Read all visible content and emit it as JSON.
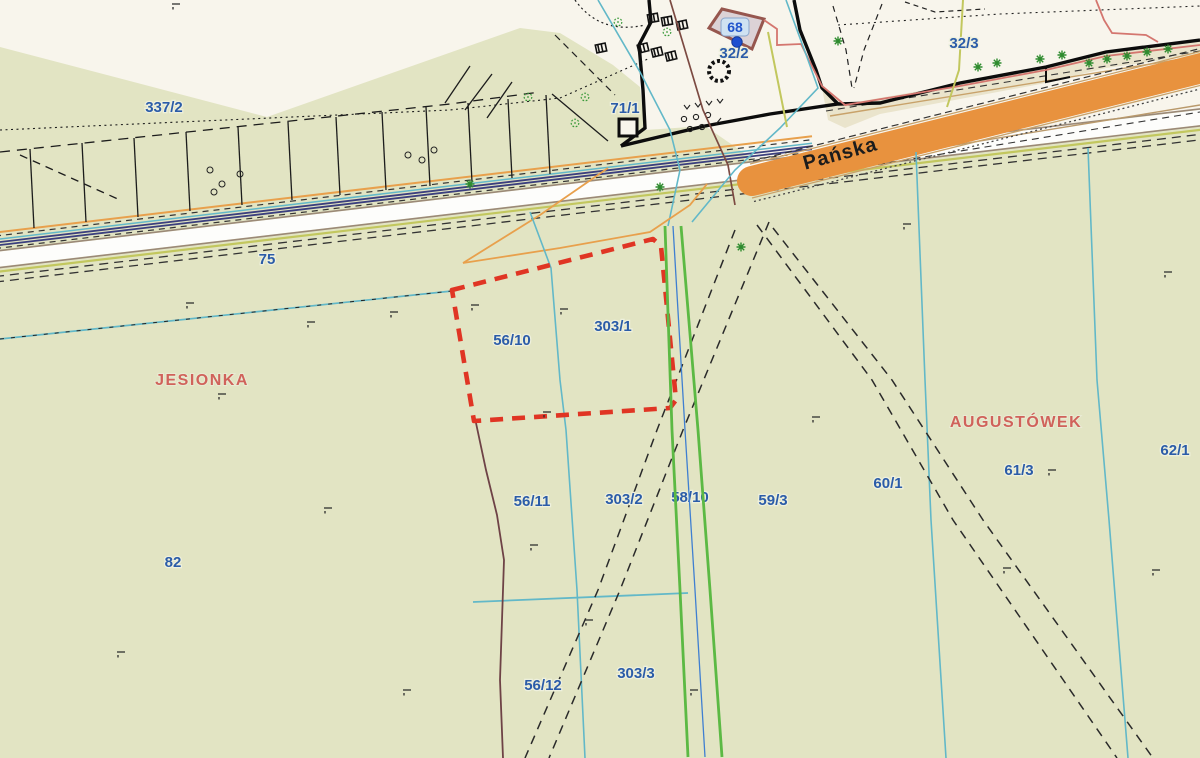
{
  "map": {
    "street": {
      "name": "Pańska"
    },
    "regions": [
      {
        "name": "JESIONKA"
      },
      {
        "name": "AUGUSTÓWEK"
      }
    ],
    "building": {
      "number": "68"
    },
    "parcels": [
      {
        "number": "337/2"
      },
      {
        "number": "71/1"
      },
      {
        "number": "32/2"
      },
      {
        "number": "32/3"
      },
      {
        "number": "75"
      },
      {
        "number": "56/10"
      },
      {
        "number": "303/1"
      },
      {
        "number": "82"
      },
      {
        "number": "56/11"
      },
      {
        "number": "303/2"
      },
      {
        "number": "58/10"
      },
      {
        "number": "59/3"
      },
      {
        "number": "60/1"
      },
      {
        "number": "61/3"
      },
      {
        "number": "62/1"
      },
      {
        "number": "56/12"
      },
      {
        "number": "303/3"
      }
    ],
    "colors": {
      "field_green": "#e2e4c3",
      "cream": "#f8f5ec",
      "road_orange": "#e8923e",
      "road_white": "#fdfdfb",
      "parcel_label_blue": "#2b5ca8",
      "region_label_red": "#d0625a",
      "selection_red": "#e03524",
      "pipeline_green": "#5cb944",
      "water_cyan": "#62b8c8",
      "utility_navy": "#3b3f7e",
      "boundary_maroon": "#7c4a42"
    }
  }
}
